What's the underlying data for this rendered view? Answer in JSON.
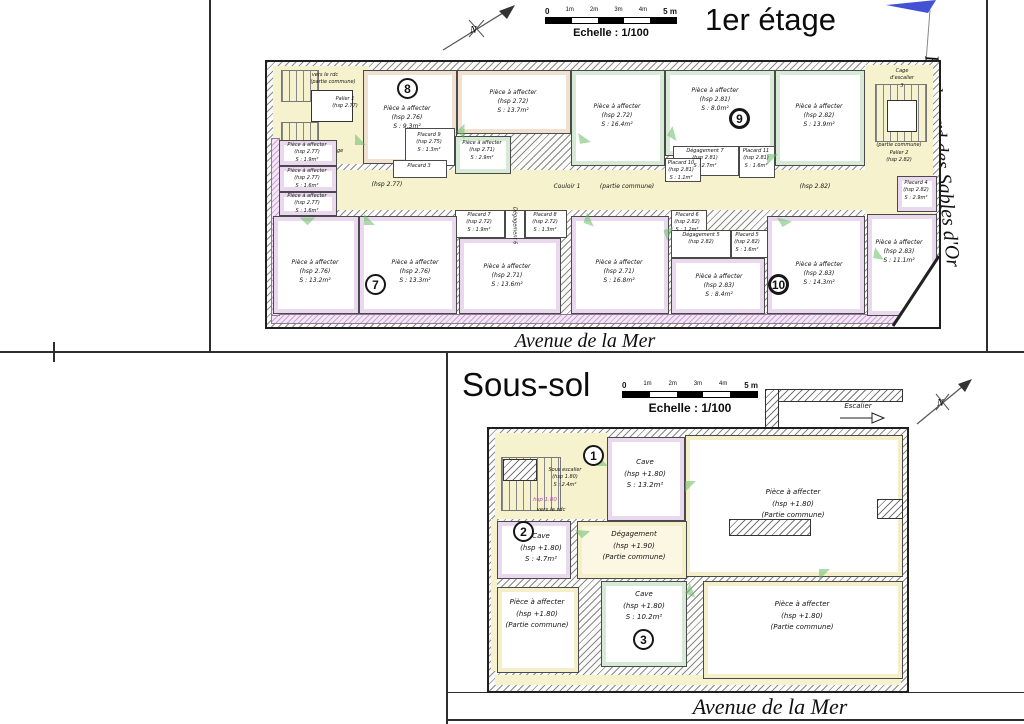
{
  "colors": {
    "wall_hatch": "#8a8a8a",
    "zone_yellow": "#f6f2cd",
    "frame_purple": "#ead8ee",
    "frame_green": "#d6ead6",
    "frame_tan": "#efe0d0",
    "door_green": "#66bd66",
    "flag_blue": "#2f3fcf",
    "note_magenta": "#bb44bb"
  },
  "floor1": {
    "title": "1er étage",
    "north": "N",
    "scale": {
      "ticks": [
        "0",
        "1m",
        "2m",
        "3m",
        "4m",
        "5 m"
      ],
      "label": "Echelle : 1/100"
    },
    "street_right": "Boulevard des Sables d'Or",
    "street_bottom": "Avenue de la Mer",
    "corridor": {
      "name": "Couloir 1",
      "common": "(partie commune)",
      "hsp_left": "(hsp 2.77)",
      "hsp_right": "(hsp 2.82)"
    },
    "stair_left": {
      "to_rdc": "vers le rdc",
      "common": "(partie commune)",
      "palier": "Palier 1",
      "palier_hsp": "(hsp 2.77)",
      "to_2nd": "vers le 2ème étage"
    },
    "stair_right": {
      "cage_l1": "Cage",
      "cage_l2": "d'escalier",
      "cage_l3": "3",
      "common": "(partie commune)",
      "palier": "Palier 2",
      "palier_hsp": "(hsp 2.82)"
    },
    "badges": {
      "b7": "7",
      "b8": "8",
      "b9": "9",
      "b10": "10"
    },
    "rooms": [
      {
        "name": "Pièce à affecter",
        "hsp": "(hsp 2.76)",
        "area": "S : 9.3m²"
      },
      {
        "name": "Pièce à affecter",
        "hsp": "(hsp 2.72)",
        "area": "S : 13.7m²"
      },
      {
        "name": "Pièce à affecter",
        "hsp": "(hsp 2.71)",
        "area": "S : 2.9m²"
      },
      {
        "name": "Placard 9",
        "hsp": "(hsp 2.75)",
        "area": "S : 1.3m²"
      },
      {
        "name": "Placard 3",
        "hsp": "",
        "area": ""
      },
      {
        "name": "Pièce à affecter",
        "hsp": "(hsp 2.72)",
        "area": "S : 16.4m²"
      },
      {
        "name": "Pièce à affecter",
        "hsp": "(hsp 2.81)",
        "area": "S : 8.0m²"
      },
      {
        "name": "Dégagement 7",
        "hsp": "(hsp 2.81)",
        "area": "S : 2.7m²"
      },
      {
        "name": "Placard 10",
        "hsp": "(hsp 2.81)",
        "area": "S : 1.1m²"
      },
      {
        "name": "Placard 11",
        "hsp": "(hsp 2.81)",
        "area": "S : 1.6m²"
      },
      {
        "name": "Pièce à affecter",
        "hsp": "(hsp 2.82)",
        "area": "S : 13.9m²"
      },
      {
        "name": "Placard 4",
        "hsp": "(hsp 2.82)",
        "area": "S : 2.9m²"
      },
      {
        "name": "Pièce à affecter",
        "hsp": "(hsp 2.77)",
        "area": "S : 1.9m²"
      },
      {
        "name": "Pièce à affecter",
        "hsp": "(hsp 2.77)",
        "area": "S : 1.6m²"
      },
      {
        "name": "Pièce à affecter",
        "hsp": "(hsp 2.77)",
        "area": "S : 1.6m²"
      },
      {
        "name": "Pièce à affecter",
        "hsp": "(hsp 2.76)",
        "area": "S : 13.2m²"
      },
      {
        "name": "Pièce à affecter",
        "hsp": "(hsp 2.76)",
        "area": "S : 13.3m²"
      },
      {
        "name": "Pièce à affecter",
        "hsp": "(hsp 2.71)",
        "area": "S : 13.6m²"
      },
      {
        "name": "Placard 7",
        "hsp": "(hsp 2.72)",
        "area": "S : 1.9m²"
      },
      {
        "name": "Dégagement 6",
        "hsp": "",
        "area": ""
      },
      {
        "name": "Placard 8",
        "hsp": "(hsp 2.72)",
        "area": "S : 1.3m²"
      },
      {
        "name": "Pièce à affecter",
        "hsp": "(hsp 2.71)",
        "area": "S : 16.8m²"
      },
      {
        "name": "Placard 6",
        "hsp": "(hsp 2.82)",
        "area": "S : 1.2m²"
      },
      {
        "name": "Dégagement 5",
        "hsp": "(hsp 2.82)",
        "area": "S : 2.7m²"
      },
      {
        "name": "Placard 5",
        "hsp": "(hsp 2.82)",
        "area": "S : 1.6m²"
      },
      {
        "name": "Pièce à affecter",
        "hsp": "(hsp 2.83)",
        "area": "S : 8.4m²"
      },
      {
        "name": "Pièce à affecter",
        "hsp": "(hsp 2.83)",
        "area": "S : 14.3m²"
      },
      {
        "name": "Pièce à affecter",
        "hsp": "(hsp 2.83)",
        "area": "S : 11.1m²"
      }
    ]
  },
  "basement": {
    "title": "Sous-sol",
    "north": "N",
    "scale": {
      "ticks": [
        "0",
        "1m",
        "2m",
        "3m",
        "4m",
        "5 m"
      ],
      "label": "Echelle : 1/100"
    },
    "street_bottom": "Avenue de la Mer",
    "escalier": "Escalier",
    "stair_note_hsp": "hsp 1.80",
    "stair_note_dir": "vers le rdc",
    "badges": {
      "b1": "1",
      "b2": "2",
      "b3": "3"
    },
    "rooms": [
      {
        "name": "Cave",
        "hsp": "(hsp +1.80)",
        "area": "S : 13.2m²"
      },
      {
        "name": "Sous escalier",
        "hsp": "(hsp 1.80)",
        "area": "S : 2.4m²"
      },
      {
        "name": "Cave",
        "hsp": "(hsp +1.80)",
        "area": "S : 4.7m²"
      },
      {
        "name": "Dégagement",
        "hsp": "(hsp +1.90)",
        "area": "(Partie commune)"
      },
      {
        "name": "Pièce à affecter",
        "hsp": "(hsp +1.80)",
        "area": "(Partie commune)"
      },
      {
        "name": "Cave",
        "hsp": "(hsp +1.80)",
        "area": "S : 10.2m²"
      },
      {
        "name": "Pièce à affecter",
        "hsp": "(hsp +1.80)",
        "area": "(Partie commune)"
      },
      {
        "name": "Pièce à affecter",
        "hsp": "(hsp +1.80)",
        "area": "(Partie commune)"
      }
    ]
  }
}
